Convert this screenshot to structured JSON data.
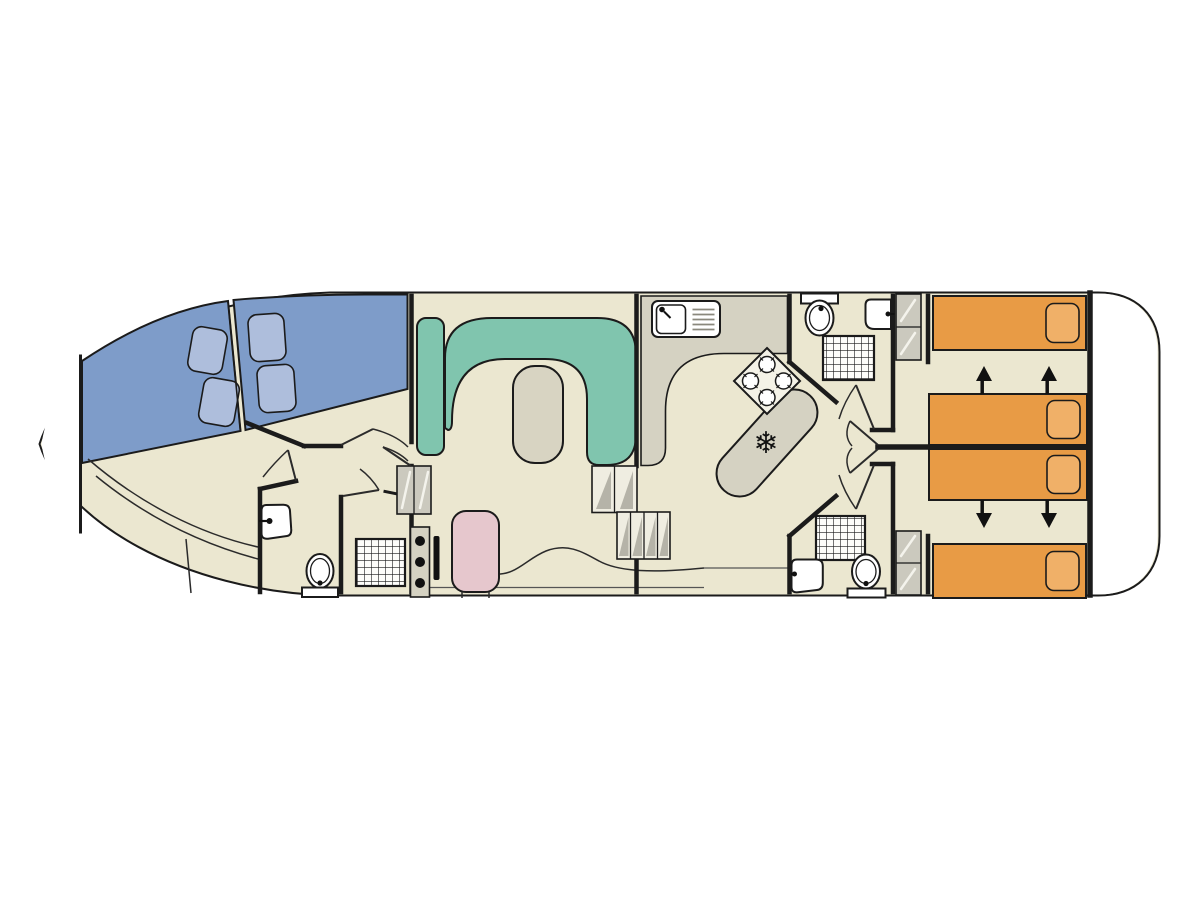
{
  "palette": {
    "page_bg": "#ffffff",
    "hull_fill": "#ebe7d0",
    "hull_stroke": "#181818",
    "deck_white": "#ffffff",
    "wall": "#1b1b1b",
    "counter": "#d5d2c2",
    "hob_plate": "#f4f2e7",
    "bed_blue": "#7e9cc9",
    "pillow_blue": "#aebedc",
    "sofa_teal": "#80c5ae",
    "table": "#d8d4c2",
    "bed_orange": "#e89b45",
    "pillow_orange": "#f0b068",
    "seat_pink": "#e6c7cd",
    "wardrobe": "#cbc9be",
    "step_fill": "#efede1",
    "step_shade": "#b5b3a8",
    "fixture_white": "#ffffff",
    "shower_grid_bg": "#fdfdfa",
    "arrow_black": "#111111"
  },
  "glyphs": {
    "snowflake": "❄"
  }
}
